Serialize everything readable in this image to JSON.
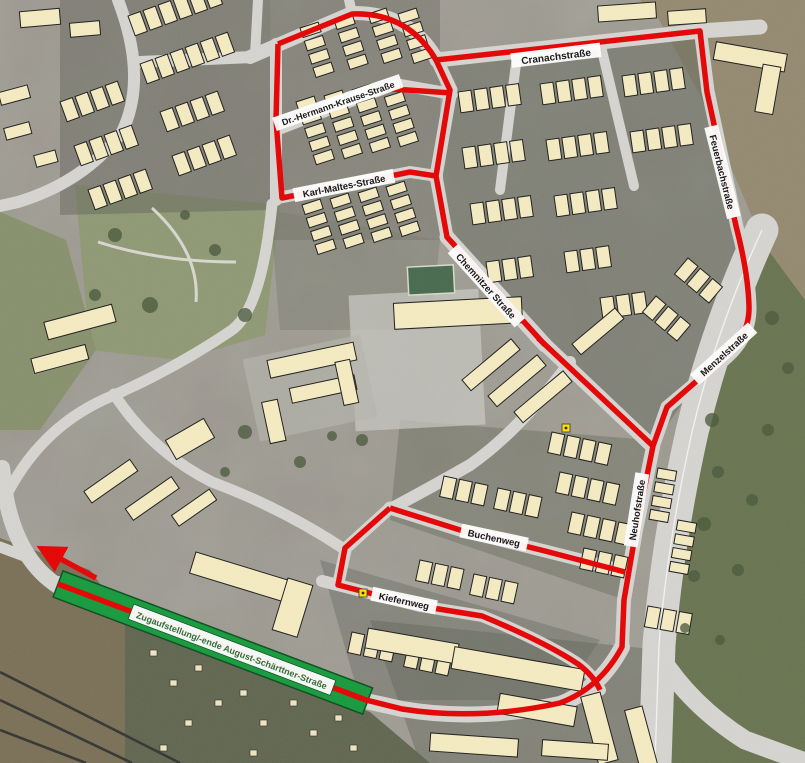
{
  "map": {
    "street_labels": [
      {
        "id": "cranachstrasse",
        "text": "Cranachstraße"
      },
      {
        "id": "dr-hermann-krause-strasse",
        "text": "Dr.-Hermann-Krause-Straße"
      },
      {
        "id": "karl-maltes-strasse",
        "text": "Karl-Maltes-Straße"
      },
      {
        "id": "chemnitzer-strasse",
        "text": "Chemnitzer Straße"
      },
      {
        "id": "feuerbachstrasse",
        "text": "Feuerbachstraße"
      },
      {
        "id": "menzelstrasse",
        "text": "Menzelstraße"
      },
      {
        "id": "neuhofstrasse",
        "text": "Neuhofstraße"
      },
      {
        "id": "buchenweg",
        "text": "Buchenweg"
      },
      {
        "id": "kiefernweg",
        "text": "Kiefernweg"
      }
    ],
    "route_banner": {
      "text": "Zugaufstellung/-ende August-Schärttner-Straße"
    },
    "colors": {
      "route_red": "#e60000",
      "assembly_green": "#149a3b",
      "banner_text": "#2d6a34",
      "building_fill": "#f6ecc2",
      "road_fill": "#d6d5d1",
      "label_bg": "#ffffff",
      "label_text": "#111111",
      "marker_yellow": "#ffe000"
    }
  }
}
